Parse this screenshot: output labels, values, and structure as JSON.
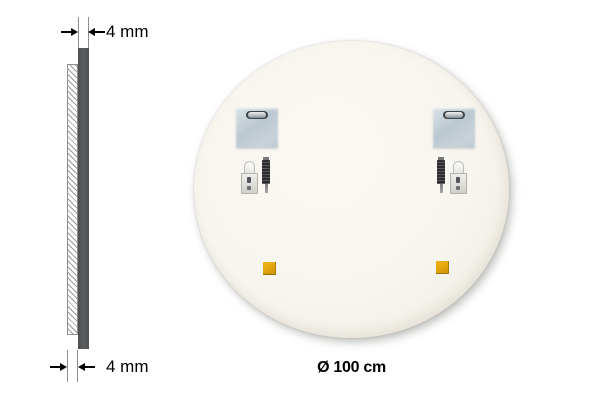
{
  "canvas": {
    "background": "#ffffff"
  },
  "side_view": {
    "top_dimension": {
      "label": "4 mm"
    },
    "bottom_dimension": {
      "label": "4 mm"
    },
    "colors": {
      "glass_bar": "#57585a",
      "hatch_line": "#9a9a9a",
      "hatch_border": "#8e8e8e",
      "extension_line": "#8e8e8e",
      "arrow": "#000000",
      "label_text": "#000000"
    }
  },
  "back_view": {
    "diameter_label": "Ø 100 cm",
    "colors": {
      "surface": "#f8f5ef",
      "surface_edge": "#eae7dd",
      "mounting_plate": "#c2cdd4",
      "plate_slot": "#3f4447",
      "adhesive_pad": "#e2a50e",
      "screw_body": "#38383a",
      "hook_metal": "#dededa"
    },
    "hardware": [
      {
        "name": "mounting-plate",
        "count": 2
      },
      {
        "name": "wall-hook",
        "count": 2
      },
      {
        "name": "screw",
        "count": 2
      },
      {
        "name": "adhesive-pad",
        "count": 2
      }
    ]
  }
}
